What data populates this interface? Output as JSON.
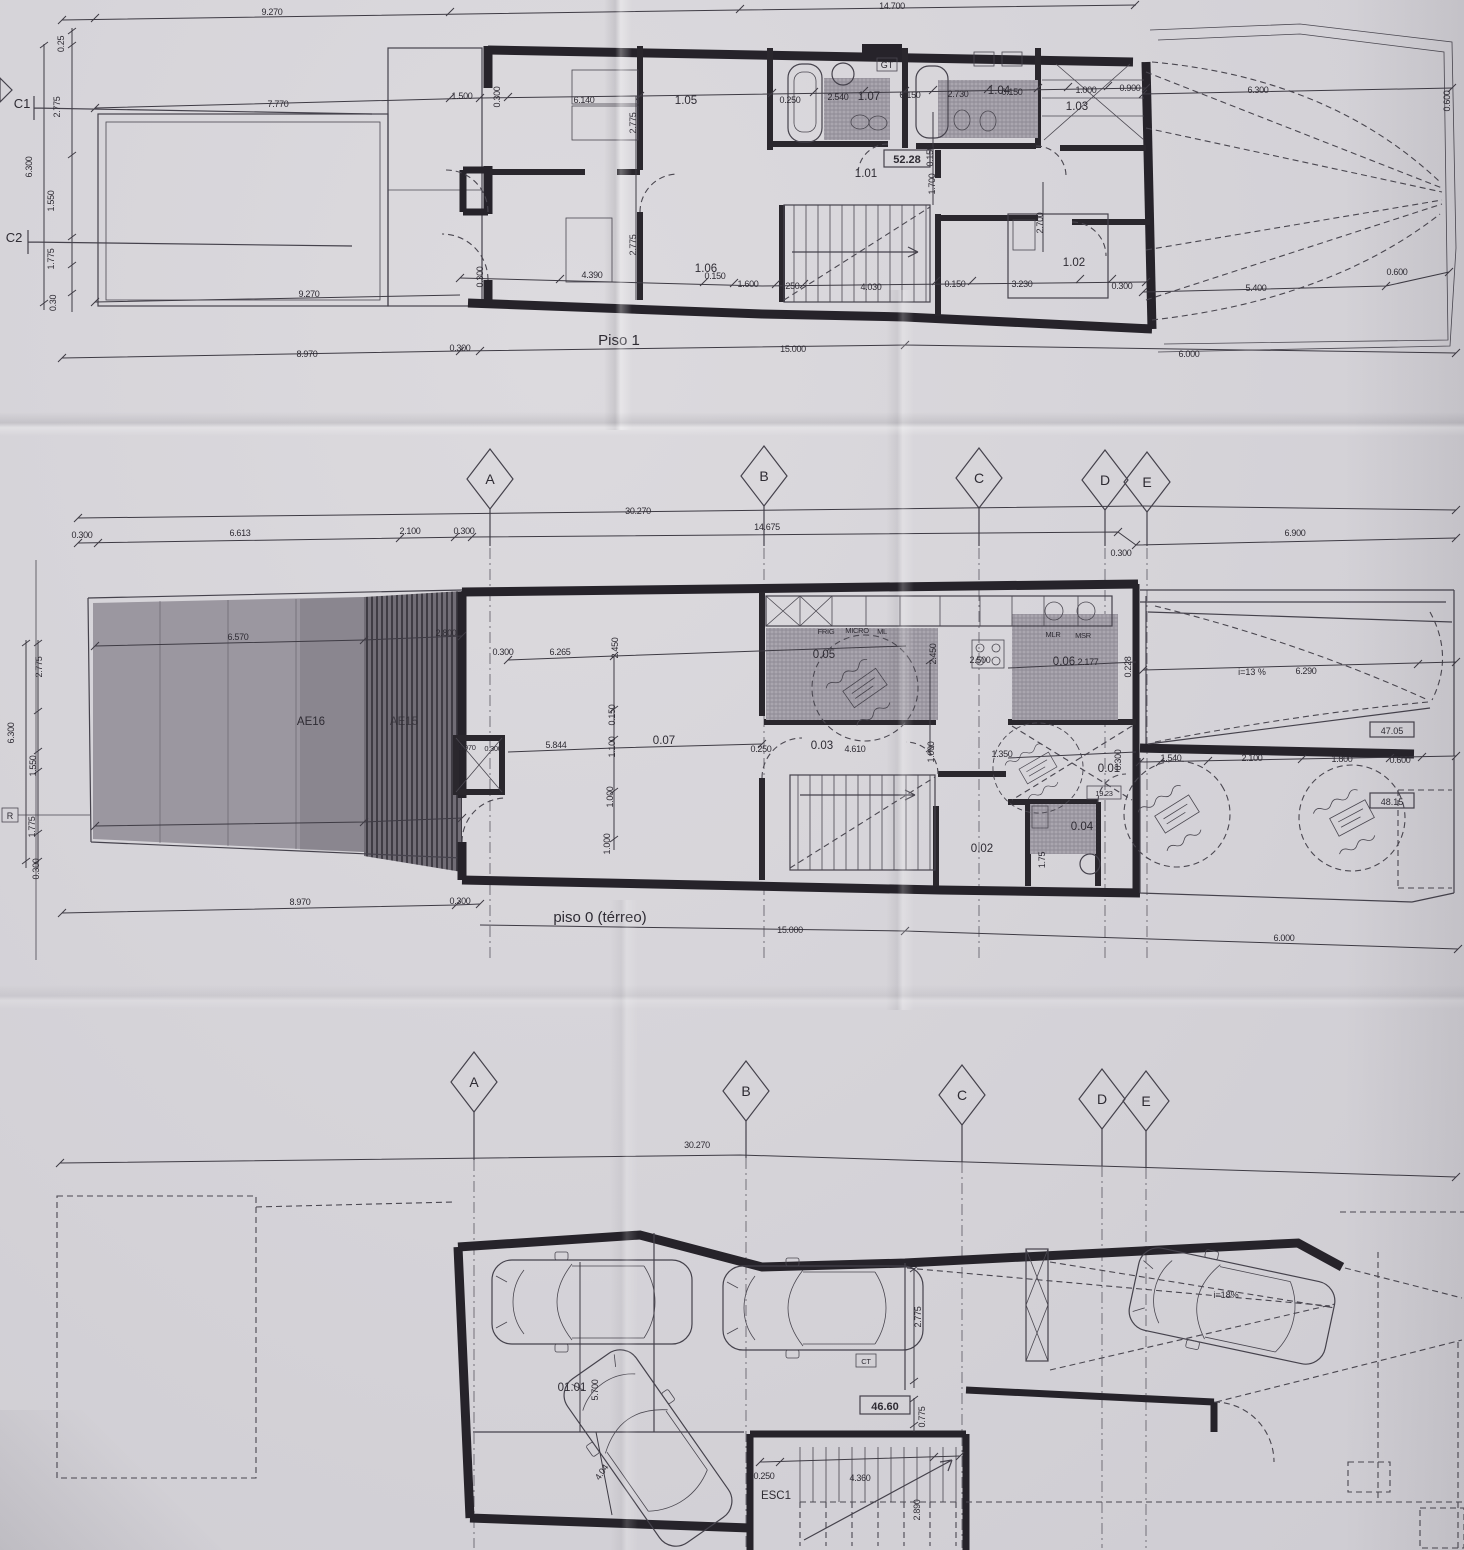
{
  "grid_letters": [
    "A",
    "B",
    "C",
    "D",
    "E"
  ],
  "axes": {
    "row1": [
      "30.270",
      "0.300",
      "6.613",
      "2.100",
      "0.300",
      "14.675",
      "0.300",
      "6.900"
    ],
    "row2": [
      "30.270"
    ]
  },
  "piso1": {
    "title": "Piso 1",
    "marks": {
      "c1": "C1",
      "c2": "C2",
      "gt": "GT",
      "area": "52.28"
    },
    "rooms": {
      "r101": "1.01",
      "r102": "1.02",
      "r103": "1.03",
      "r104": "1.04",
      "r105": "1.05",
      "r106": "1.06",
      "r107": "1.07"
    },
    "dims": [
      "9.270",
      "14.700",
      "0.25",
      "2.775",
      "6.300",
      "1.550",
      "1.775",
      "0.30",
      "7.770",
      "1.500",
      "0.300",
      "6.140",
      "2.775",
      "0.250",
      "2.540",
      "0.150",
      "2.730",
      "0.150",
      "1.000",
      "0.900",
      "6.300",
      "0.600",
      "0.150",
      "1.700",
      "2.700",
      "2.775",
      "0.300",
      "4.390",
      "0.150",
      "1.600",
      "0.250",
      "4.030",
      "0.150",
      "3.230",
      "0.300",
      "5.400",
      "0.600",
      "9.270",
      "8.970",
      "0.300",
      "15.000",
      "6.000"
    ]
  },
  "piso0": {
    "title": "piso 0 (térreo)",
    "zones": {
      "ae16": "AE16",
      "ae15": "AE15",
      "r": "R"
    },
    "rooms": {
      "r001": "0.01",
      "r002": "0.02",
      "r003": "0.03",
      "r004": "0.04",
      "r005": "0.05",
      "r006": "0.06",
      "r007": "0.07"
    },
    "areas": {
      "a1": "47.05",
      "a2": "48.15",
      "a3": "19.23"
    },
    "appliances": [
      "FRIG",
      "MICRO",
      "ML",
      "MLR",
      "MSR"
    ],
    "ramp": {
      "slope": "i=13 %",
      "length": "6.290"
    },
    "dims": [
      "2.775",
      "6.300",
      "1.550",
      "1.775",
      "0.300",
      "6.570",
      "2.800",
      "0.300",
      "6.265",
      "2.450",
      "0.150",
      "1.100",
      "1.000",
      "1.000",
      "5.844",
      "0.250",
      "4.610",
      "1.000",
      "2.450",
      "2.500",
      "2.177",
      "0.228",
      "1.350",
      "0.300",
      "1.540",
      "2.100",
      "1.800",
      "0.600",
      "1.75",
      "8.970",
      "0.300",
      "15.000",
      "6.000",
      "0.970",
      "0.300"
    ]
  },
  "cave": {
    "rooms": {
      "r0101": "01.01",
      "esc": "ESC1",
      "ct": "CT",
      "area": "46.60"
    },
    "ramp": {
      "slope": "i=18%"
    },
    "dims": [
      "5.700",
      "4.04",
      "2.775",
      "0.775",
      "0.250",
      "4.360",
      "2.890"
    ]
  }
}
